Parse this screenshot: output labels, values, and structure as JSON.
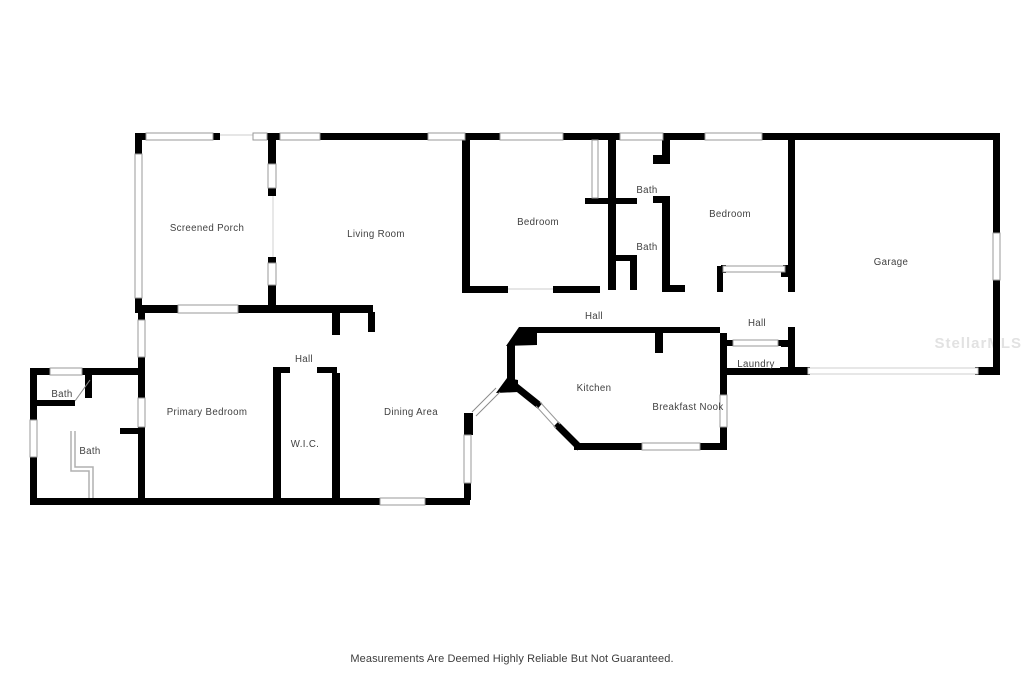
{
  "floor_plan": {
    "watermark": "StellarMLS",
    "disclaimer": "Measurements Are Deemed Highly Reliable But Not Guaranteed.",
    "colors": {
      "wall": "#000000",
      "window_outline": "#999999",
      "label": "#3f3f3f",
      "watermark": "#e2e2e2",
      "disclaimer": "#3c3c3c",
      "background": "#ffffff"
    },
    "rooms": [
      {
        "id": "screened-porch",
        "label": "Screened Porch",
        "x": 207,
        "y": 231
      },
      {
        "id": "living-room",
        "label": "Living Room",
        "x": 376,
        "y": 237
      },
      {
        "id": "bedroom-1",
        "label": "Bedroom",
        "x": 538,
        "y": 225
      },
      {
        "id": "bath-1",
        "label": "Bath",
        "x": 647,
        "y": 193
      },
      {
        "id": "bath-2",
        "label": "Bath",
        "x": 647,
        "y": 250
      },
      {
        "id": "bedroom-2",
        "label": "Bedroom",
        "x": 730,
        "y": 217
      },
      {
        "id": "garage",
        "label": "Garage",
        "x": 891,
        "y": 265
      },
      {
        "id": "hall-main",
        "label": "Hall",
        "x": 594,
        "y": 319
      },
      {
        "id": "hall-right",
        "label": "Hall",
        "x": 757,
        "y": 326
      },
      {
        "id": "laundry",
        "label": "Laundry",
        "x": 756,
        "y": 367
      },
      {
        "id": "kitchen",
        "label": "Kitchen",
        "x": 594,
        "y": 391
      },
      {
        "id": "breakfast-nook",
        "label": "Breakfast Nook",
        "x": 688,
        "y": 410
      },
      {
        "id": "hall-left",
        "label": "Hall",
        "x": 304,
        "y": 362
      },
      {
        "id": "wic",
        "label": "W.I.C.",
        "x": 305,
        "y": 447
      },
      {
        "id": "primary-bedroom",
        "label": "Primary Bedroom",
        "x": 207,
        "y": 415
      },
      {
        "id": "dining-area",
        "label": "Dining Area",
        "x": 411,
        "y": 415
      },
      {
        "id": "bath-3",
        "label": "Bath",
        "x": 62,
        "y": 397
      },
      {
        "id": "bath-4",
        "label": "Bath",
        "x": 90,
        "y": 454
      }
    ]
  }
}
